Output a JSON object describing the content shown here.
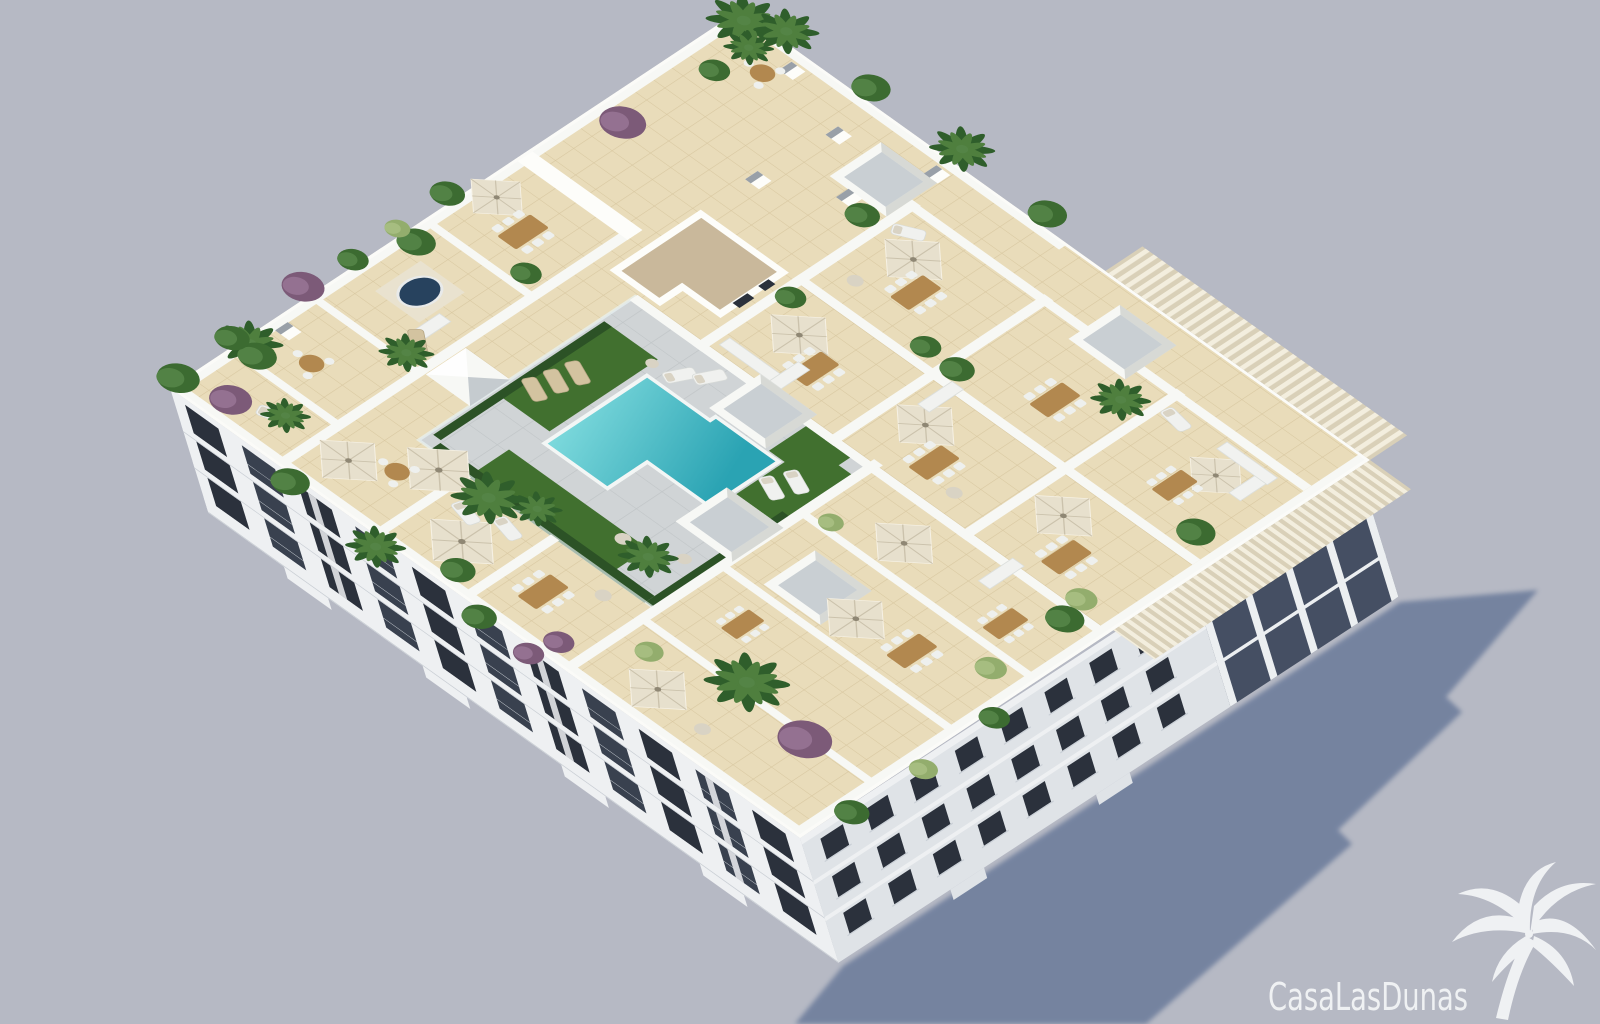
{
  "watermark": {
    "brand": "CasaLasDunas",
    "icon": "palm-tree-icon"
  },
  "scene": {
    "type": "3d-architectural-render",
    "view": "aerial-axonometric",
    "subject": "white apartment residence with communal rooftop pool terrace",
    "features": [
      "T-shaped turquoise swimming pool",
      "grey pool deck with glass balustrade",
      "artificial grass sun decks with loungers",
      "private roof terraces divided by white walls",
      "beige ceramic tile flooring",
      "cream market parasols",
      "wooden dining tables with white chairs",
      "white lounge sofas",
      "rooftop jacuzzi",
      "white skylight boxes",
      "stair core with tan gravel flat roof",
      "slatted timber pergola on the east corner",
      "palms, green and purple shrubs in planters",
      "white facades with dark glazed balconies",
      "long cast shadow on the ground to the south-east"
    ]
  },
  "palette": {
    "bg": "#b6b9c4",
    "ground_shadow": "#6e7e9c",
    "wall_white": "#f7f8f5",
    "tile": "#e9dcba",
    "tile_line": "#d8c7a0",
    "deck": "#d0d4d6",
    "deck_line": "#c0c5c7",
    "pool_light": "#7edadd",
    "pool_deep": "#2aa3b3",
    "grass": "#41702f",
    "hedge": "#2c5226",
    "core_roof_tan": "#c9b89b",
    "facade_light": "#eef0f2",
    "facade_side": "#dfe3e7",
    "glass_dark": "#2b313c",
    "glass_panel": "#454f63",
    "wood": "#b2884f",
    "umbrella": "#e7e0cd",
    "plant_dark": "#3c6b31",
    "plant_mid": "#558447",
    "plant_purple": "#7c5a78",
    "plant_light": "#93ad6d",
    "pillar_cap": "#99a0a8",
    "box_inner": "#c9cfd3",
    "watermark": "#f3f4f6"
  }
}
